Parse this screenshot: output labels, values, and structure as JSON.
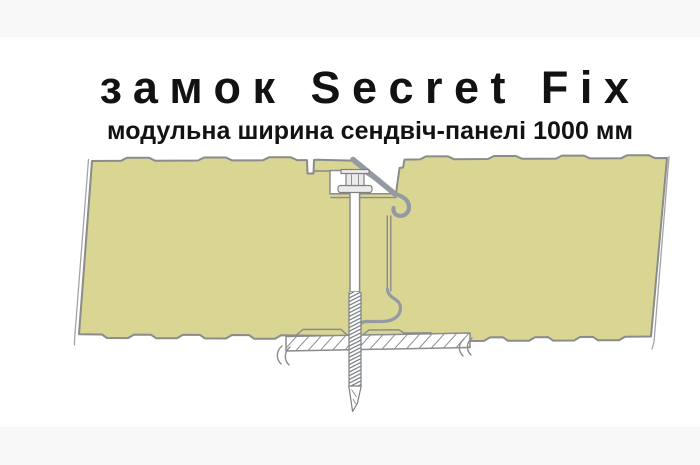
{
  "header": {
    "title": "замок Secret Fix",
    "subtitle": "модульна ширина сендвіч-панелі 1000 мм"
  },
  "colors": {
    "background": "#ffffff",
    "band": "#f8f8f8",
    "ink": "#121212",
    "panel_fill": "#d9d694",
    "outline": "#8b8b8b",
    "metal": "#949aa1"
  }
}
